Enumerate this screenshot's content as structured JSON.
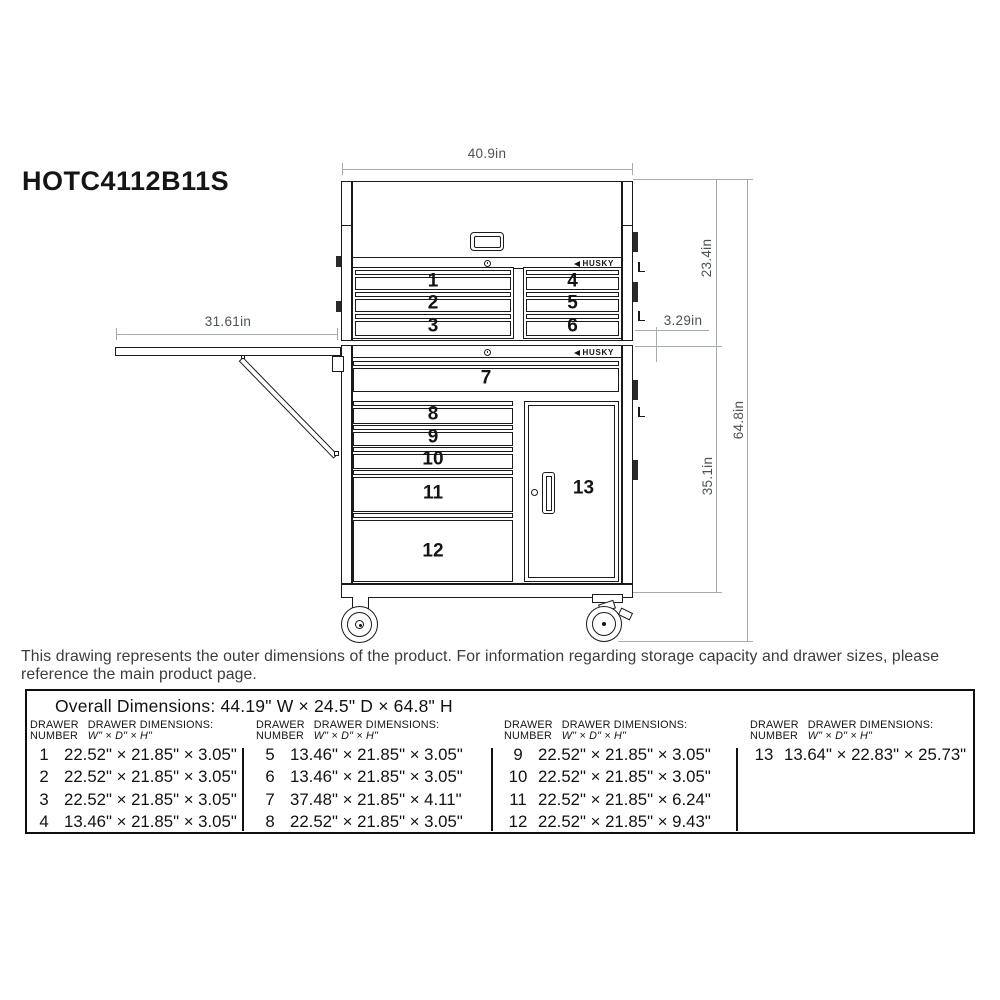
{
  "title": "HOTC4112B11S",
  "brand": "HUSKY",
  "diagram": {
    "dims": {
      "top_width": "40.9in",
      "shelf_width": "31.61in",
      "top_unit_height": "23.4in",
      "stack_gap": "3.29in",
      "total_height": "64.8in",
      "bottom_unit_height": "35.1in"
    },
    "top_chest": {
      "left_drawers": [
        "1",
        "2",
        "3"
      ],
      "right_drawers": [
        "4",
        "5",
        "6"
      ]
    },
    "cabinet": {
      "full_width_drawer": "7",
      "left_drawers": [
        "8",
        "9",
        "10",
        "11",
        "12"
      ],
      "door": "13"
    }
  },
  "disclaimer": "This drawing represents the outer dimensions of the product. For information regarding storage capacity and drawer sizes, please\nreference the main product page.",
  "table": {
    "overall_dimensions": "Overall Dimensions: 44.19\" W × 24.5\" D × 64.8\" H",
    "header": {
      "col1_line1": "DRAWER",
      "col1_line2": "NUMBER",
      "col2_line1": "DRAWER DIMENSIONS:",
      "col2_line2": "W\" × D\" × H\""
    },
    "groups": [
      {
        "rows": [
          {
            "n": "1",
            "dims": "22.52\" × 21.85\" × 3.05\""
          },
          {
            "n": "2",
            "dims": "22.52\" × 21.85\" × 3.05\""
          },
          {
            "n": "3",
            "dims": "22.52\" × 21.85\" × 3.05\""
          },
          {
            "n": "4",
            "dims": "13.46\" × 21.85\" × 3.05\""
          }
        ]
      },
      {
        "rows": [
          {
            "n": "5",
            "dims": "13.46\" × 21.85\" × 3.05\""
          },
          {
            "n": "6",
            "dims": "13.46\" × 21.85\" × 3.05\""
          },
          {
            "n": "7",
            "dims": "37.48\" × 21.85\" × 4.11\""
          },
          {
            "n": "8",
            "dims": "22.52\" × 21.85\" × 3.05\""
          }
        ]
      },
      {
        "rows": [
          {
            "n": "9",
            "dims": "22.52\" × 21.85\" × 3.05\""
          },
          {
            "n": "10",
            "dims": "22.52\" × 21.85\" × 3.05\""
          },
          {
            "n": "11",
            "dims": "22.52\" × 21.85\" × 6.24\""
          },
          {
            "n": "12",
            "dims": "22.52\" × 21.85\" × 9.43\""
          }
        ]
      },
      {
        "rows": [
          {
            "n": "13",
            "dims": "13.64\" × 22.83\" × 25.73\""
          }
        ]
      }
    ]
  }
}
